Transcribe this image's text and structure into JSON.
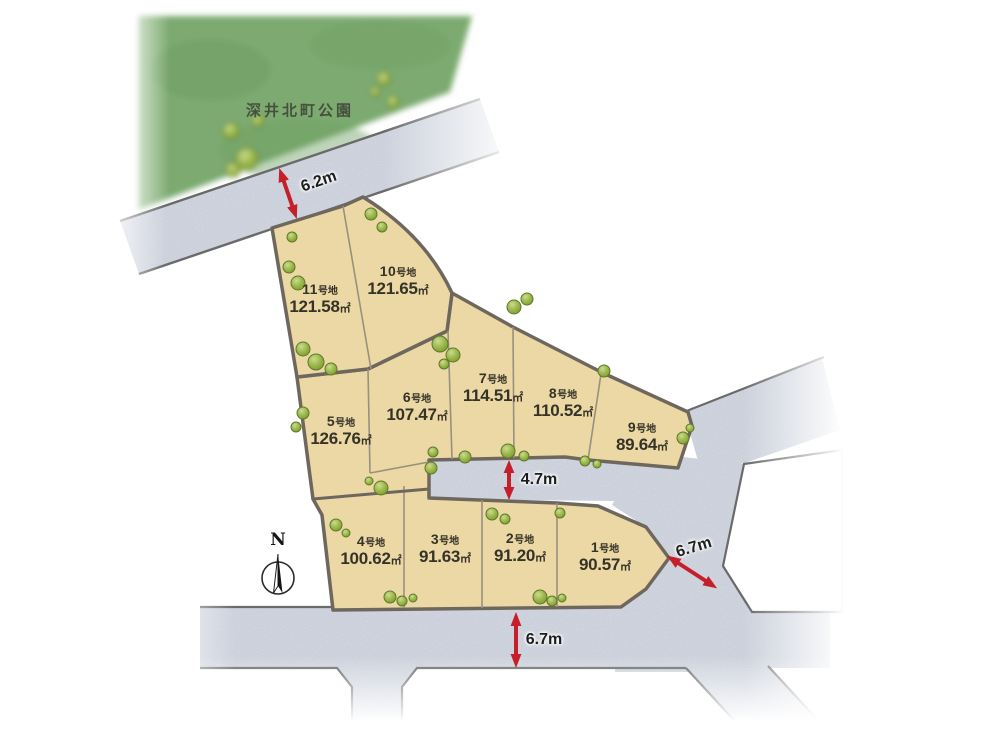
{
  "park": {
    "label": "深井北町公園"
  },
  "compass": {
    "label": "N"
  },
  "measurements": {
    "north_road": "6.2m",
    "center_road": "4.7m",
    "east_road": "6.7m",
    "south_road": "6.7m"
  },
  "lots": [
    {
      "no": "1",
      "suffix": "号地",
      "area": "90.57",
      "unit": "㎡"
    },
    {
      "no": "2",
      "suffix": "号地",
      "area": "91.20",
      "unit": "㎡"
    },
    {
      "no": "3",
      "suffix": "号地",
      "area": "91.63",
      "unit": "㎡"
    },
    {
      "no": "4",
      "suffix": "号地",
      "area": "100.62",
      "unit": "㎡"
    },
    {
      "no": "5",
      "suffix": "号地",
      "area": "126.76",
      "unit": "㎡"
    },
    {
      "no": "6",
      "suffix": "号地",
      "area": "107.47",
      "unit": "㎡"
    },
    {
      "no": "7",
      "suffix": "号地",
      "area": "114.51",
      "unit": "㎡"
    },
    {
      "no": "8",
      "suffix": "号地",
      "area": "110.52",
      "unit": "㎡"
    },
    {
      "no": "9",
      "suffix": "号地",
      "area": "89.64",
      "unit": "㎡"
    },
    {
      "no": "10",
      "suffix": "号地",
      "area": "121.65",
      "unit": "㎡"
    },
    {
      "no": "11",
      "suffix": "号地",
      "area": "121.58",
      "unit": "㎡"
    }
  ],
  "colors": {
    "lot_fill": "#ecd8a4",
    "road_fill": "#c6ccd8",
    "park_green": "#7dab6f",
    "arrow_red": "#c5202a",
    "boundary": "#6e675d"
  }
}
